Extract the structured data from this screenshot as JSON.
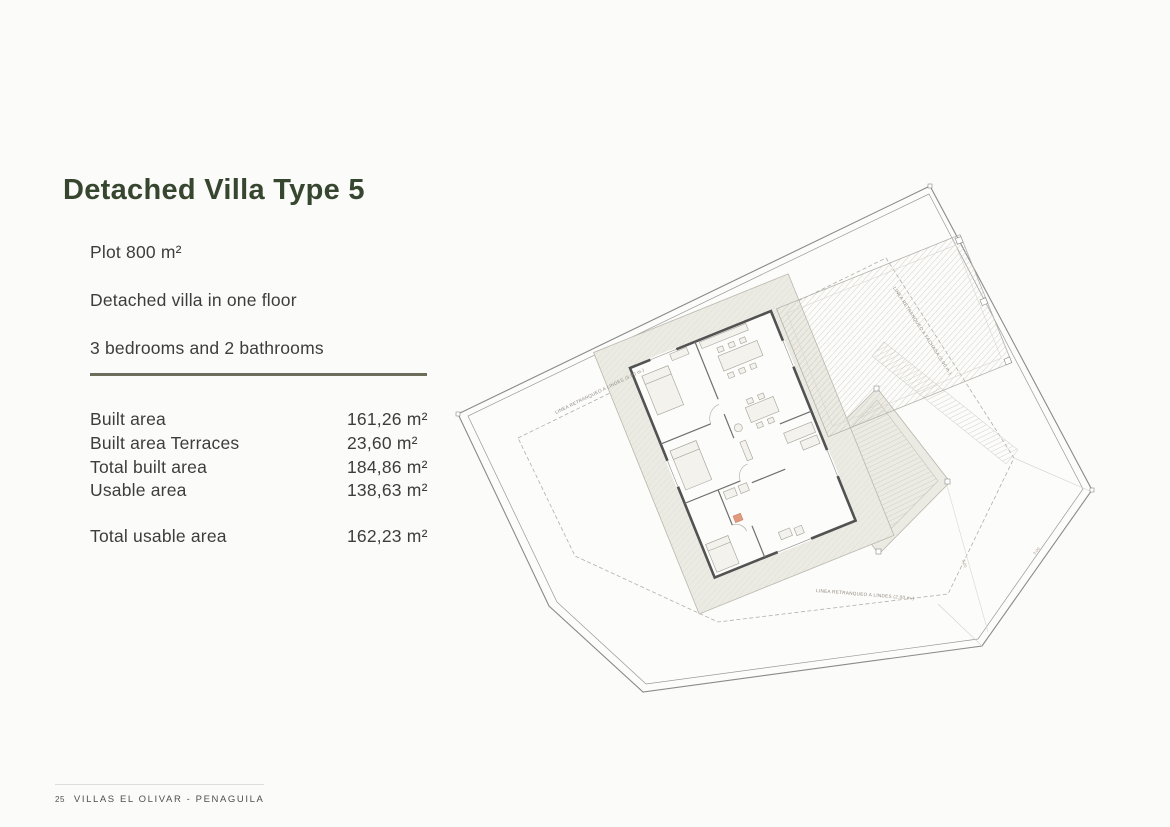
{
  "header": {
    "title": "Detached Villa Type 5",
    "title_color": "#37462e"
  },
  "specs": {
    "plot": "Plot 800 m²",
    "floors": "Detached villa in one floor",
    "rooms": "3 bedrooms and 2 bathrooms"
  },
  "areas": {
    "rows": [
      {
        "label": "Built area",
        "value": "161,26 m²"
      },
      {
        "label": "Built area Terraces",
        "value": "23,60 m²"
      },
      {
        "label": "Total built area",
        "value": "184,86 m²"
      },
      {
        "label": "Usable area",
        "value": "138,63 m²"
      }
    ],
    "total": {
      "label": "Total usable area",
      "value": "162,23 m²"
    }
  },
  "footer": {
    "page_number": "25",
    "text": "VILLAS EL OLIVAR - PENAGUILA"
  },
  "plan": {
    "labels": {
      "setback_boundary_top": "LINEA RETRANQUEO A LINDES (3.00 m.)",
      "setback_facade_right": "LINEA RETRANQUEO A FACHADA (5.00 m.)",
      "setback_boundary_bottom": "LINEA RETRANQUEO A LINDES (2.00 m.)",
      "dim_1": "5.00",
      "dim_2": "3.00"
    },
    "colors": {
      "plot_outline": "#8a8a8a",
      "setback_line": "#b0b0a8",
      "house_walls": "#525252",
      "terrace_band": "#ecebe3",
      "hatch": "#c9c7bd",
      "divider": "#6d6d5b"
    }
  }
}
